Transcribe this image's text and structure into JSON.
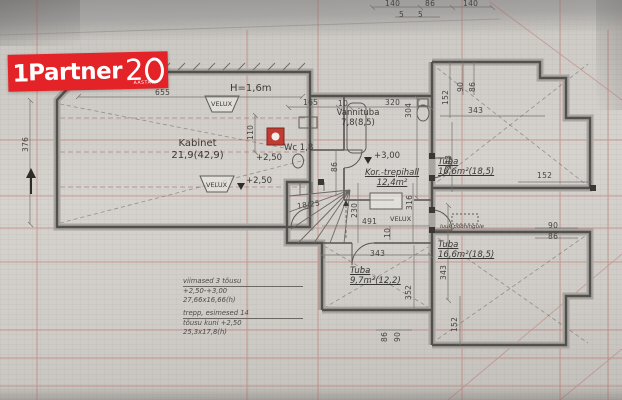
{
  "logo": {
    "brand_left": "1",
    "brand_name": "Partner",
    "brand_number_2": "2",
    "brand_sub": "AASTAT"
  },
  "rooms": {
    "kabinet": {
      "name": "Kabinet",
      "area": "21,9(42,9)"
    },
    "vannituba": {
      "name": "Vannituba",
      "area": "7,8(8,5)"
    },
    "wc": {
      "name": "Wc 1,8"
    },
    "trepihall": {
      "name": "Kor.-trepihall",
      "area": "12,4m²"
    },
    "tuba_ne": {
      "name": "Tuba",
      "area": "16,6m²(18,5)"
    },
    "tuba_se": {
      "name": "Tuba",
      "area": "16,6m²(18,5)"
    },
    "tuba_s": {
      "name": "Tuba",
      "area": "9,7m²(12,2)"
    }
  },
  "annotations": {
    "height_note": "H=1,6m",
    "velux": "VELUX",
    "level_250": "+2,50",
    "level_300": "+3,00",
    "attic_hatch": "luuk pööningule",
    "stair_mark": "18/25"
  },
  "dims": {
    "top_140a": "140",
    "top_86": "86",
    "top_140b": "140",
    "top_5a": "5",
    "top_5b": "5",
    "kabinet_w": "655",
    "kabinet_h": "376",
    "k_110": "110",
    "m_165": "165",
    "m_10": "10",
    "m_320": "320",
    "m_304": "304",
    "m_86": "86",
    "st_230": "230",
    "st_316": "316",
    "st_491": "491",
    "st_10": "10",
    "ne_90": "90",
    "ne_86": "86",
    "ne_152": "152",
    "ne_343h": "343",
    "ne_343v": "343",
    "e_152": "152",
    "e_90": "90",
    "e_86": "86",
    "s_343h": "343",
    "s_343v": "343",
    "s_352": "352",
    "s_86": "86",
    "s_90": "90",
    "s_152": "152"
  },
  "notes": {
    "line1": "viimased 3 tõusu",
    "line2": "+2,50-+3,00",
    "line3": "27,66x16,66(h)",
    "line4": "trepp, esimesed 14",
    "line5": "tõusu kuni +2,50",
    "line6": "25,3x17,8(h)"
  },
  "colors": {
    "logo_red": "#e32327",
    "grid_red": "#b85550",
    "wall_dark": "#52504c",
    "chimney_red": "#c23b33"
  }
}
